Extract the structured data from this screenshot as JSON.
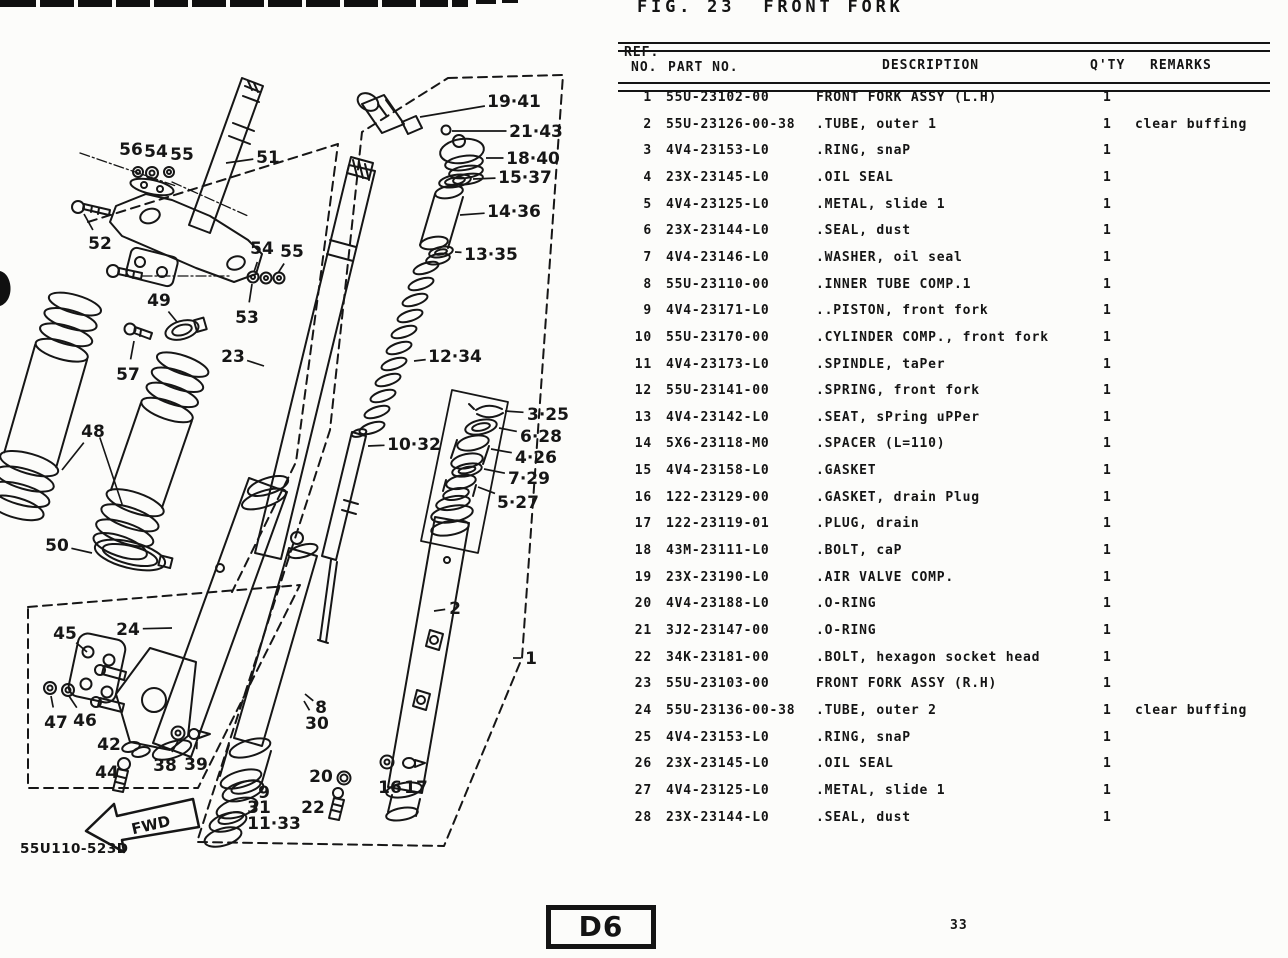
{
  "page": {
    "title": "FIG. 23  FRONT FORK",
    "plate_code": "D6",
    "page_number": "33",
    "drawing_number": "55U110-523D",
    "fwd_label": "FWD"
  },
  "table": {
    "headers": {
      "ref_line1": "REF.",
      "ref_line2": "NO.",
      "part": "PART NO.",
      "description": "DESCRIPTION",
      "qty": "Q'TY",
      "remarks": "REMARKS"
    },
    "rows": [
      {
        "ref": "1",
        "part": "55U-23102-00",
        "desc": "FRONT FORK ASSY (L.H)",
        "qty": "1",
        "remarks": ""
      },
      {
        "ref": "2",
        "part": "55U-23126-00-38",
        "desc": ".TUBE, outer 1",
        "qty": "1",
        "remarks": "clear buffing"
      },
      {
        "ref": "3",
        "part": "4V4-23153-L0",
        "desc": ".RING, snaP",
        "qty": "1",
        "remarks": ""
      },
      {
        "ref": "4",
        "part": "23X-23145-L0",
        "desc": ".OIL SEAL",
        "qty": "1",
        "remarks": ""
      },
      {
        "ref": "5",
        "part": "4V4-23125-L0",
        "desc": ".METAL, slide 1",
        "qty": "1",
        "remarks": ""
      },
      {
        "ref": "6",
        "part": "23X-23144-L0",
        "desc": ".SEAL, dust",
        "qty": "1",
        "remarks": ""
      },
      {
        "ref": "7",
        "part": "4V4-23146-L0",
        "desc": ".WASHER, oil seal",
        "qty": "1",
        "remarks": ""
      },
      {
        "ref": "8",
        "part": "55U-23110-00",
        "desc": ".INNER TUBE COMP.1",
        "qty": "1",
        "remarks": ""
      },
      {
        "ref": "9",
        "part": "4V4-23171-L0",
        "desc": "..PISTON, front fork",
        "qty": "1",
        "remarks": ""
      },
      {
        "ref": "10",
        "part": "55U-23170-00",
        "desc": ".CYLINDER COMP., front fork",
        "qty": "1",
        "remarks": ""
      },
      {
        "ref": "11",
        "part": "4V4-23173-L0",
        "desc": ".SPINDLE, taPer",
        "qty": "1",
        "remarks": ""
      },
      {
        "ref": "12",
        "part": "55U-23141-00",
        "desc": ".SPRING, front fork",
        "qty": "1",
        "remarks": ""
      },
      {
        "ref": "13",
        "part": "4V4-23142-L0",
        "desc": ".SEAT, sPring uPPer",
        "qty": "1",
        "remarks": ""
      },
      {
        "ref": "14",
        "part": "5X6-23118-M0",
        "desc": ".SPACER (L=110)",
        "qty": "1",
        "remarks": ""
      },
      {
        "ref": "15",
        "part": "4V4-23158-L0",
        "desc": ".GASKET",
        "qty": "1",
        "remarks": ""
      },
      {
        "ref": "16",
        "part": "122-23129-00",
        "desc": ".GASKET, drain Plug",
        "qty": "1",
        "remarks": ""
      },
      {
        "ref": "17",
        "part": "122-23119-01",
        "desc": ".PLUG, drain",
        "qty": "1",
        "remarks": ""
      },
      {
        "ref": "18",
        "part": "43M-23111-L0",
        "desc": ".BOLT, caP",
        "qty": "1",
        "remarks": ""
      },
      {
        "ref": "19",
        "part": "23X-23190-L0",
        "desc": ".AIR VALVE COMP.",
        "qty": "1",
        "remarks": ""
      },
      {
        "ref": "20",
        "part": "4V4-23188-L0",
        "desc": ".O-RING",
        "qty": "1",
        "remarks": ""
      },
      {
        "ref": "21",
        "part": "3J2-23147-00",
        "desc": ".O-RING",
        "qty": "1",
        "remarks": ""
      },
      {
        "ref": "22",
        "part": "34K-23181-00",
        "desc": ".BOLT, hexagon socket head",
        "qty": "1",
        "remarks": ""
      },
      {
        "ref": "23",
        "part": "55U-23103-00",
        "desc": "FRONT FORK ASSY (R.H)",
        "qty": "1",
        "remarks": ""
      },
      {
        "ref": "24",
        "part": "55U-23136-00-38",
        "desc": ".TUBE, outer 2",
        "qty": "1",
        "remarks": "clear buffing"
      },
      {
        "ref": "25",
        "part": "4V4-23153-L0",
        "desc": ".RING, snaP",
        "qty": "1",
        "remarks": ""
      },
      {
        "ref": "26",
        "part": "23X-23145-L0",
        "desc": ".OIL SEAL",
        "qty": "1",
        "remarks": ""
      },
      {
        "ref": "27",
        "part": "4V4-23125-L0",
        "desc": ".METAL, slide 1",
        "qty": "1",
        "remarks": ""
      },
      {
        "ref": "28",
        "part": "23X-23144-L0",
        "desc": ".SEAL, dust",
        "qty": "1",
        "remarks": ""
      }
    ]
  },
  "diagram": {
    "callouts": [
      {
        "t": "56",
        "x": 131,
        "y": 149,
        "lx": 138,
        "ly": 168
      },
      {
        "t": "54",
        "x": 156,
        "y": 151,
        "lx": 151,
        "ly": 169
      },
      {
        "t": "55",
        "x": 182,
        "y": 154,
        "lx": 169,
        "ly": 169
      },
      {
        "t": "51",
        "x": 268,
        "y": 157,
        "lx": 226,
        "ly": 163
      },
      {
        "t": "52",
        "x": 100,
        "y": 243,
        "lx": 84,
        "ly": 214
      },
      {
        "t": "54",
        "x": 262,
        "y": 248,
        "lx": 254,
        "ly": 272
      },
      {
        "t": "55",
        "x": 292,
        "y": 251,
        "lx": 278,
        "ly": 273
      },
      {
        "t": "53",
        "x": 247,
        "y": 317,
        "lx": 252,
        "ly": 284
      },
      {
        "t": "49",
        "x": 159,
        "y": 300,
        "lx": 177,
        "ly": 322
      },
      {
        "t": "57",
        "x": 128,
        "y": 374,
        "lx": 134,
        "ly": 341
      },
      {
        "t": "23",
        "x": 233,
        "y": 356,
        "lx": 264,
        "ly": 366
      },
      {
        "t": "48",
        "x": 93,
        "y": 431,
        "lx": 62,
        "ly": 470
      },
      {
        "t": "50",
        "x": 57,
        "y": 545,
        "lx": 92,
        "ly": 553
      },
      {
        "t": "24",
        "x": 128,
        "y": 629,
        "lx": 172,
        "ly": 628
      },
      {
        "t": "45",
        "x": 65,
        "y": 633,
        "lx": 87,
        "ly": 652
      },
      {
        "t": "47",
        "x": 56,
        "y": 722,
        "lx": 51,
        "ly": 696
      },
      {
        "t": "46",
        "x": 85,
        "y": 720,
        "lx": 69,
        "ly": 696
      },
      {
        "t": "42",
        "x": 109,
        "y": 744,
        "lx": 127,
        "ly": 749
      },
      {
        "t": "44",
        "x": 107,
        "y": 772,
        "lx": 121,
        "ly": 769
      },
      {
        "t": "38",
        "x": 165,
        "y": 765,
        "lx": 178,
        "ly": 741
      },
      {
        "t": "39",
        "x": 196,
        "y": 764,
        "lx": 197,
        "ly": 742
      },
      {
        "t": "19·41",
        "x": 514,
        "y": 101,
        "lx": 420,
        "ly": 117
      },
      {
        "t": "21·43",
        "x": 536,
        "y": 131,
        "lx": 452,
        "ly": 131
      },
      {
        "t": "18·40",
        "x": 533,
        "y": 158,
        "lx": 486,
        "ly": 158
      },
      {
        "t": "15·37",
        "x": 525,
        "y": 177,
        "lx": 473,
        "ly": 179
      },
      {
        "t": "14·36",
        "x": 514,
        "y": 211,
        "lx": 460,
        "ly": 215
      },
      {
        "t": "13·35",
        "x": 491,
        "y": 254,
        "lx": 455,
        "ly": 252
      },
      {
        "t": "12·34",
        "x": 455,
        "y": 356,
        "lx": 414,
        "ly": 361
      },
      {
        "t": "10·32",
        "x": 414,
        "y": 444,
        "lx": 368,
        "ly": 446
      },
      {
        "t": "3·25",
        "x": 548,
        "y": 414,
        "lx": 505,
        "ly": 411
      },
      {
        "t": "6·28",
        "x": 541,
        "y": 436,
        "lx": 499,
        "ly": 428
      },
      {
        "t": "4·26",
        "x": 536,
        "y": 457,
        "lx": 491,
        "ly": 449
      },
      {
        "t": "7·29",
        "x": 529,
        "y": 478,
        "lx": 484,
        "ly": 469
      },
      {
        "t": "5·27",
        "x": 518,
        "y": 502,
        "lx": 478,
        "ly": 487
      },
      {
        "t": "2",
        "x": 455,
        "y": 608,
        "lx": 434,
        "ly": 611
      },
      {
        "t": "1",
        "x": 531,
        "y": 658,
        "lx": 513,
        "ly": 658
      },
      {
        "t": "8",
        "x": 321,
        "y": 707,
        "lx": 305,
        "ly": 694
      },
      {
        "t": "30",
        "x": 317,
        "y": 723,
        "lx": 304,
        "ly": 701
      },
      {
        "t": "20",
        "x": 321,
        "y": 776,
        "lx": 336,
        "ly": 778
      },
      {
        "t": "22",
        "x": 313,
        "y": 807,
        "lx": 330,
        "ly": 798
      },
      {
        "t": "16",
        "x": 390,
        "y": 787,
        "lx": 389,
        "ly": 775
      },
      {
        "t": "17",
        "x": 416,
        "y": 787,
        "lx": 412,
        "ly": 772
      },
      {
        "t": "9",
        "x": 264,
        "y": 792,
        "lx": 252,
        "ly": 793
      },
      {
        "t": "31",
        "x": 259,
        "y": 807,
        "lx": 249,
        "ly": 801
      },
      {
        "t": "11·33",
        "x": 274,
        "y": 823,
        "lx": 249,
        "ly": 821
      }
    ]
  }
}
